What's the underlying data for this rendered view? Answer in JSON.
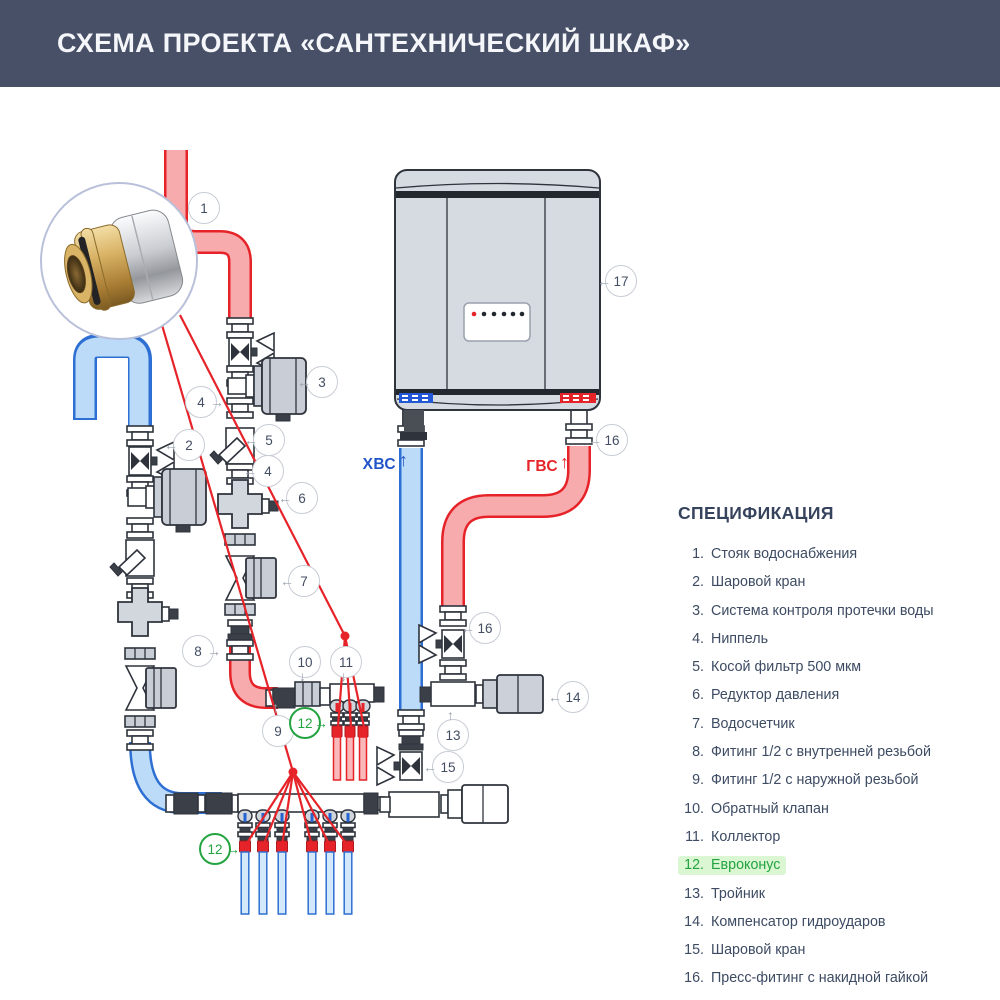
{
  "header": {
    "title": "СХЕМА ПРОЕКТА «САНТЕХНИЧЕСКИЙ ШКАФ»"
  },
  "spec": {
    "title": "СПЕЦИФИКАЦИЯ",
    "items": [
      {
        "num": "1.",
        "label": "Стояк водоснабжения"
      },
      {
        "num": "2.",
        "label": "Шаровой кран"
      },
      {
        "num": "3.",
        "label": "Система контроля протечки воды"
      },
      {
        "num": "4.",
        "label": "Ниппель"
      },
      {
        "num": "5.",
        "label": "Косой фильтр 500 мкм"
      },
      {
        "num": "6.",
        "label": "Редуктор давления"
      },
      {
        "num": "7.",
        "label": "Водосчетчик"
      },
      {
        "num": "8.",
        "label": "Фитинг 1/2 с внутренней резьбой"
      },
      {
        "num": "9.",
        "label": "Фитинг 1/2 с наружной резьбой"
      },
      {
        "num": "10.",
        "label": "Обратный клапан"
      },
      {
        "num": "11.",
        "label": "Коллектор"
      },
      {
        "num": "12.",
        "label": "Евроконус",
        "highlighted": true
      },
      {
        "num": "13.",
        "label": "Тройник"
      },
      {
        "num": "14.",
        "label": "Компенсатор гидроударов"
      },
      {
        "num": "15.",
        "label": "Шаровой кран"
      },
      {
        "num": "16.",
        "label": "Пресс-фитинг с накидной гайкой"
      },
      {
        "num": "17.",
        "label": "Водонагреватель"
      }
    ]
  },
  "diagram": {
    "pipe_labels": {
      "cold": "ХВС",
      "hot": "ГВС"
    },
    "callouts": [
      {
        "number": "1"
      },
      {
        "number": "2"
      },
      {
        "number": "3"
      },
      {
        "number": "4"
      },
      {
        "number": "5"
      },
      {
        "number": "4"
      },
      {
        "number": "6"
      },
      {
        "number": "7"
      },
      {
        "number": "8"
      },
      {
        "number": "9"
      },
      {
        "number": "10"
      },
      {
        "number": "11"
      },
      {
        "number": "12"
      },
      {
        "number": "13"
      },
      {
        "number": "14"
      },
      {
        "number": "15"
      },
      {
        "number": "16"
      },
      {
        "number": "16"
      },
      {
        "number": "12"
      },
      {
        "number": "17"
      }
    ]
  },
  "icons": {
    "arrow_left": "←",
    "arrow_right": "→",
    "arrow_up": "↑",
    "arrow_down": "↓"
  },
  "colors": {
    "header_bg": "#485068",
    "hot": "#e52329",
    "hot_fill": "#f8abad",
    "cold": "#2d6fd2",
    "cold_fill": "#bcdbf8",
    "green_accent": "#23a441",
    "green_highlight_bg": "#daf6d2"
  }
}
